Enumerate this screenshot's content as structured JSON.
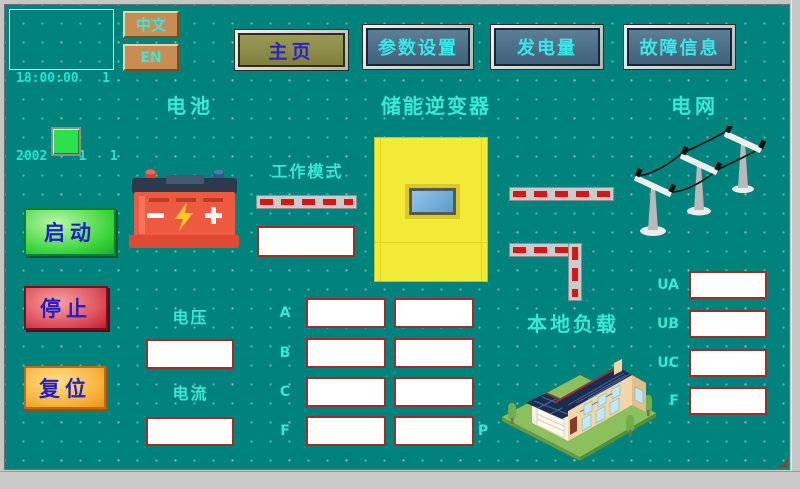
{
  "header": {
    "clock": {
      "line1": "18:00:00   1",
      "line2": "2002    1   1"
    },
    "language": {
      "chinese": "中文",
      "english": "EN"
    },
    "nav": [
      {
        "id": "home",
        "label": "主页",
        "active": true
      },
      {
        "id": "params",
        "label": "参数设置",
        "active": false
      },
      {
        "id": "generation",
        "label": "发电量",
        "active": false
      },
      {
        "id": "faults",
        "label": "故障信息",
        "active": false
      }
    ]
  },
  "sections": {
    "battery": "电池",
    "inverter": "储能逆变器",
    "grid": "电网",
    "local_load": "本地负载",
    "work_mode": "工作模式",
    "voltage": "电压",
    "current": "电流"
  },
  "controls": {
    "start": "启动",
    "stop": "停止",
    "reset": "复位"
  },
  "fields": {
    "work_mode_value": "",
    "voltage_value": "",
    "current_value": "",
    "phase_rows": [
      {
        "label": "A",
        "inverter_value": "",
        "grid_value": ""
      },
      {
        "label": "B",
        "inverter_value": "",
        "grid_value": ""
      },
      {
        "label": "C",
        "inverter_value": "",
        "grid_value": ""
      },
      {
        "label": "F",
        "inverter_value": "",
        "grid_value": ""
      }
    ],
    "p_label": "P",
    "grid_rows": [
      {
        "label": "UA",
        "value": ""
      },
      {
        "label": "UB",
        "value": ""
      },
      {
        "label": "UC",
        "value": ""
      },
      {
        "label": "F",
        "value": ""
      }
    ]
  },
  "icons": {
    "battery": "battery-icon",
    "towers": "transmission-towers-icon",
    "house": "solar-house-icon",
    "lamp": "run-indicator-lamp"
  },
  "colors": {
    "background": "#00837c",
    "label_cyan": "#3ae8d6",
    "nav_button": "#4e7186",
    "home_button": "#8d8d4a",
    "button_text_blue": "#2222c8",
    "indicator_green": "#2ce24c",
    "start_green": "#35d335",
    "stop_red": "#d84050",
    "reset_orange": "#f5a832",
    "pipe_dash_red": "#de1414",
    "inverter_yellow": "#f2ea36",
    "box_border_red": "#9e2f28"
  }
}
